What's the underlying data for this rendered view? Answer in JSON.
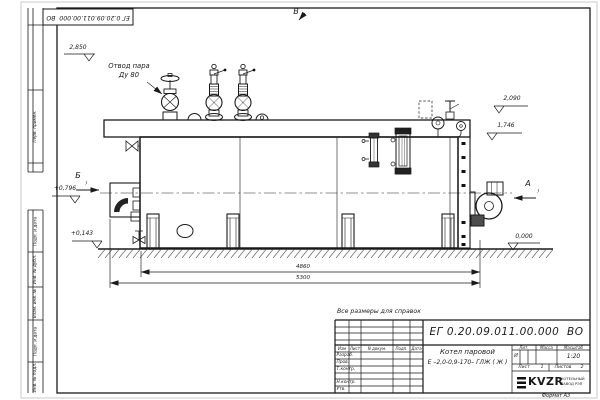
{
  "doc": {
    "number": "ЕГ 0.20.09.011.00.000  ВО",
    "format": "Формат А3",
    "note": "Все размеры для справок"
  },
  "margin": {
    "perv": "Перв. примен.",
    "podp1": "Подп. и дата",
    "inv_dubl": "Инв. № дубл.",
    "vzam": "Взам. инв. №",
    "podp2": "Подп. и дата",
    "inv_podl": "Инв. № подл."
  },
  "tb": {
    "izm": "Изм",
    "list": "Лист",
    "ndoc": "N докум.",
    "podp": "Подп.",
    "data": "Дата",
    "rows": {
      "r1": "Разраб.",
      "r2": "Пров.",
      "r3": "Т.контр.",
      "r4": "Н.контр.",
      "r5": "Утв."
    },
    "name1": "Котел паровой",
    "name2": "Е –2,0-0,9-170– ГЛЖ ( Ж )",
    "lit": "Лит.",
    "lit_v": "И",
    "mass": "Масса",
    "scale": "Масштаб",
    "scale_v": "1:20",
    "sheet": "Лист",
    "sheet_v": "1",
    "sheets": "Листов",
    "sheets_v": "2",
    "logo": "KVZR",
    "logo1": "КОТЕЛЬНЫЙ",
    "logo2": "ЗАВОД РЭП"
  },
  "ann": {
    "steam1": "Отвод пара",
    "steam2": "Ду 80",
    "va": "А",
    "vb": "Б",
    "vv": "В",
    "e2850": "2,850",
    "e2090": "2,090",
    "e1746": "1,746",
    "e0796": "+0,796",
    "e0143": "+0,143",
    "e0000": "0,000",
    "d4860": "4860",
    "d5300": "5300"
  }
}
